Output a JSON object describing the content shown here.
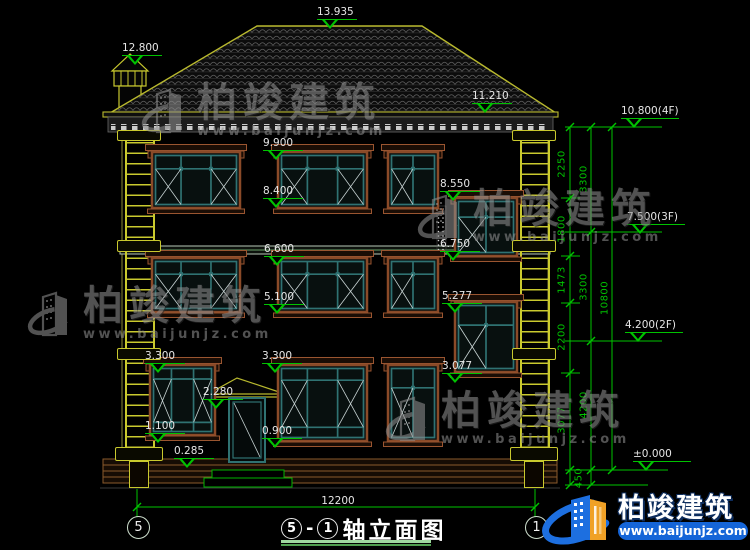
{
  "page": {
    "background": "#000000"
  },
  "watermark": {
    "brand": "柏竣建筑",
    "url": "www.baijunjz.com"
  },
  "footer_logo": {
    "brand": "柏竣建筑",
    "url": "www.baijunjz.com"
  },
  "title_block": {
    "axis_left": "5",
    "separator": "-",
    "axis_right": "1",
    "name": "轴立面图",
    "width_dim": "12200"
  },
  "colors": {
    "dim_green": "#00c300",
    "annotation_white": "#e6e6e6",
    "frame_brown": "#9a5530",
    "glazing_teal": "#2f7272",
    "quoin_yellow": "#c9c92e",
    "logo_blue": "#1d6fe0",
    "logo_orange": "#f0a126"
  },
  "elevation_markers": [
    {
      "label": "13.935",
      "x": 317,
      "y": 7
    },
    {
      "label": "12.800",
      "x": 122,
      "y": 43
    },
    {
      "label": "11.210",
      "x": 472,
      "y": 91
    },
    {
      "label": "9.900",
      "x": 263,
      "y": 138
    },
    {
      "label": "8.400",
      "x": 263,
      "y": 186
    },
    {
      "label": "8.550",
      "x": 440,
      "y": 179
    },
    {
      "label": "6.600",
      "x": 264,
      "y": 244
    },
    {
      "label": "6.750",
      "x": 440,
      "y": 239
    },
    {
      "label": "5.100",
      "x": 264,
      "y": 292
    },
    {
      "label": "5.277",
      "x": 442,
      "y": 291
    },
    {
      "label": "3.300",
      "x": 145,
      "y": 351
    },
    {
      "label": "3.300",
      "x": 262,
      "y": 351
    },
    {
      "label": "3.077",
      "x": 442,
      "y": 361
    },
    {
      "label": "2.280",
      "x": 203,
      "y": 387
    },
    {
      "label": "1.100",
      "x": 145,
      "y": 421
    },
    {
      "label": "0.900",
      "x": 262,
      "y": 426
    },
    {
      "label": "0.285",
      "x": 174,
      "y": 446
    }
  ],
  "level_markers": [
    {
      "label": "10.800(4F)",
      "x": 621,
      "y": 106,
      "line_y": 127
    },
    {
      "label": "7.500(3F)",
      "x": 627,
      "y": 212,
      "line_y": 232
    },
    {
      "label": "4.200(2F)",
      "x": 625,
      "y": 320,
      "line_y": 341
    },
    {
      "label": "±0.000",
      "x": 633,
      "y": 449,
      "line_y": 470
    }
  ],
  "chain_dims": [
    {
      "t": "2250",
      "x": 562,
      "y": 164
    },
    {
      "t": "1800",
      "x": 562,
      "y": 229
    },
    {
      "t": "1473",
      "x": 562,
      "y": 280
    },
    {
      "t": "2200",
      "x": 562,
      "y": 337
    },
    {
      "t": "3077",
      "x": 562,
      "y": 420
    },
    {
      "t": "3300",
      "x": 584,
      "y": 179
    },
    {
      "t": "3300",
      "x": 584,
      "y": 287
    },
    {
      "t": "4200",
      "x": 584,
      "y": 405
    },
    {
      "t": "10800",
      "x": 605,
      "y": 298
    },
    {
      "t": "450",
      "x": 579,
      "y": 478
    }
  ]
}
